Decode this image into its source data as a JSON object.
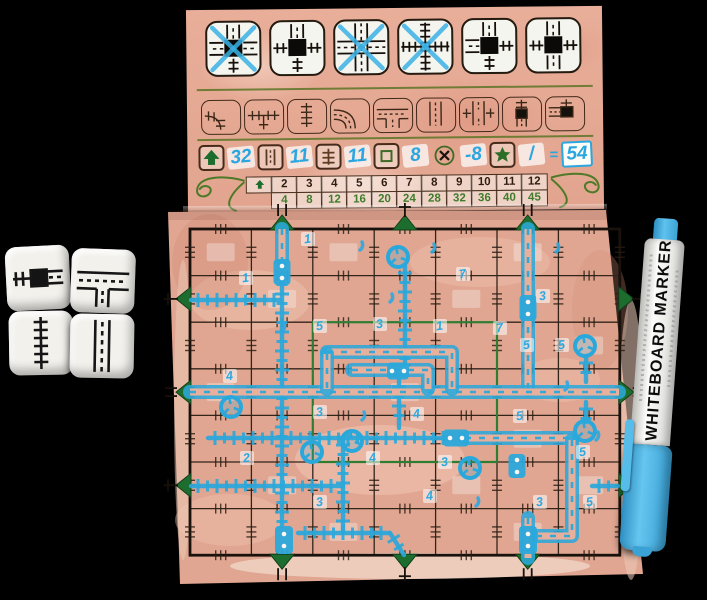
{
  "scene": {
    "background": "#000000"
  },
  "board": {
    "palette": {
      "paper": "#e2a894",
      "paper_light": "#f2cdb9",
      "line_dark": "#221812",
      "brown": "#4a2e1c",
      "olive": "#5c7426",
      "green": "#1d6e2e",
      "marker_blue": "#2ba8db",
      "tile_white": "#f5f5ef"
    },
    "special_tiles": [
      {
        "name": "special-road3-rail1",
        "up": "road",
        "right": "road",
        "down": "rail",
        "left": "road",
        "square": true,
        "crossed": true
      },
      {
        "name": "special-rail3-road1",
        "up": "road",
        "right": "rail",
        "down": "rail",
        "left": "rail",
        "square": true,
        "crossed": false
      },
      {
        "name": "special-road4",
        "up": "road",
        "right": "road",
        "down": "road",
        "left": "road",
        "square": false,
        "crossed": true
      },
      {
        "name": "special-rail4",
        "up": "rail",
        "right": "rail",
        "down": "rail",
        "left": "rail",
        "square": false,
        "crossed": true
      },
      {
        "name": "special-station-cross",
        "up": "road",
        "right": "rail",
        "down": "rail",
        "left": "road",
        "square": true,
        "crossed": false
      },
      {
        "name": "special-station-parallel",
        "up": "road",
        "right": "rail",
        "down": "road",
        "left": "rail",
        "square": true,
        "crossed": false
      }
    ],
    "reference_tiles": [
      "rail-curve",
      "rail-junction",
      "rail-straight",
      "road-curve",
      "road-junction",
      "road-straight",
      "overpass",
      "station-straight",
      "station-curve"
    ],
    "score_row": {
      "items": [
        {
          "icon": "exits-arrow-icon",
          "value": "32"
        },
        {
          "icon": "road-icon",
          "value": "11"
        },
        {
          "icon": "rail-icon",
          "value": "11"
        },
        {
          "icon": "center-square-icon",
          "value": "8"
        },
        {
          "icon": "error-cross-icon",
          "value": "-8"
        },
        {
          "icon": "star-icon",
          "value": "/"
        }
      ],
      "equals": "=",
      "total": "54"
    },
    "score_table": {
      "exit_counts": [
        "2",
        "3",
        "4",
        "5",
        "6",
        "7",
        "8",
        "9",
        "10",
        "11",
        "12"
      ],
      "points": [
        "4",
        "8",
        "12",
        "16",
        "20",
        "24",
        "28",
        "32",
        "36",
        "40",
        "45"
      ]
    },
    "grid": {
      "cols": 7,
      "rows": 7,
      "exits": {
        "top": [
          {
            "pos": 2,
            "type": "road"
          },
          {
            "pos": 4,
            "type": "rail"
          },
          {
            "pos": 6,
            "type": "road"
          }
        ],
        "bottom": [
          {
            "pos": 2,
            "type": "road"
          },
          {
            "pos": 4,
            "type": "rail"
          },
          {
            "pos": 6,
            "type": "road"
          }
        ],
        "left": [
          {
            "pos": 2,
            "type": "rail"
          },
          {
            "pos": 4,
            "type": "road"
          },
          {
            "pos": 6,
            "type": "rail"
          }
        ],
        "right": [
          {
            "pos": 2,
            "type": "rail"
          },
          {
            "pos": 4,
            "type": "road"
          },
          {
            "pos": 6,
            "type": "rail"
          }
        ]
      }
    },
    "drawing": {
      "rails": [
        [
          191,
          300,
          280,
          300
        ],
        [
          282,
          268,
          282,
          484
        ],
        [
          282,
          486,
          282,
          527
        ],
        [
          208,
          438,
          450,
          438
        ],
        [
          191,
          486,
          343,
          486
        ],
        [
          343,
          438,
          343,
          532
        ],
        [
          298,
          533,
          390,
          533
        ],
        [
          390,
          533,
          404,
          555
        ],
        [
          405,
          266,
          405,
          364
        ],
        [
          399,
          380,
          399,
          428
        ],
        [
          586,
          356,
          586,
          382
        ],
        [
          586,
          402,
          586,
          422
        ],
        [
          592,
          486,
          618,
          486
        ]
      ],
      "roads": [
        [
          [
            282,
            229
          ],
          [
            282,
            260
          ]
        ],
        [
          [
            528,
            229
          ],
          [
            528,
            390
          ]
        ],
        [
          [
            190,
            392
          ],
          [
            619,
            392
          ]
        ],
        [
          [
            327,
            352
          ],
          [
            452,
            352
          ],
          [
            452,
            389
          ]
        ],
        [
          [
            327,
            354
          ],
          [
            327,
            389
          ]
        ],
        [
          [
            352,
            370
          ],
          [
            428,
            370
          ],
          [
            428,
            389
          ]
        ],
        [
          [
            465,
            438
          ],
          [
            572,
            438
          ]
        ],
        [
          [
            572,
            440
          ],
          [
            572,
            536
          ],
          [
            538,
            536
          ]
        ],
        [
          [
            528,
            518
          ],
          [
            528,
            558
          ]
        ]
      ],
      "stations": [
        {
          "x": 282,
          "y": 272,
          "w": 17,
          "h": 26,
          "o": "v"
        },
        {
          "x": 528,
          "y": 308,
          "w": 17,
          "h": 26,
          "o": "v"
        },
        {
          "x": 398,
          "y": 371,
          "w": 22,
          "h": 17,
          "o": "h"
        },
        {
          "x": 456,
          "y": 438,
          "w": 26,
          "h": 17,
          "o": "h"
        },
        {
          "x": 284,
          "y": 540,
          "w": 18,
          "h": 28,
          "o": "v"
        },
        {
          "x": 528,
          "y": 540,
          "w": 18,
          "h": 28,
          "o": "v"
        },
        {
          "x": 517,
          "y": 466,
          "w": 17,
          "h": 24,
          "o": "v"
        }
      ],
      "roundabouts": [
        [
          398,
          257
        ],
        [
          585,
          346
        ],
        [
          585,
          431
        ],
        [
          231,
          407
        ],
        [
          312,
          452
        ],
        [
          352,
          441
        ],
        [
          470,
          468
        ]
      ],
      "digits": [
        {
          "t": "1",
          "x": 246,
          "y": 282
        },
        {
          "t": "1",
          "x": 308,
          "y": 243
        },
        {
          "t": "7",
          "x": 463,
          "y": 278
        },
        {
          "t": "3",
          "x": 543,
          "y": 300
        },
        {
          "t": "5",
          "x": 320,
          "y": 330
        },
        {
          "t": "3",
          "x": 380,
          "y": 328
        },
        {
          "t": "1",
          "x": 440,
          "y": 330
        },
        {
          "t": "7",
          "x": 500,
          "y": 332
        },
        {
          "t": "4",
          "x": 230,
          "y": 380
        },
        {
          "t": "5",
          "x": 527,
          "y": 349
        },
        {
          "t": "5",
          "x": 562,
          "y": 349
        },
        {
          "t": "3",
          "x": 320,
          "y": 416
        },
        {
          "t": "4",
          "x": 417,
          "y": 418
        },
        {
          "t": "5",
          "x": 520,
          "y": 420
        },
        {
          "t": "5",
          "x": 583,
          "y": 456
        },
        {
          "t": "2",
          "x": 247,
          "y": 462
        },
        {
          "t": "4",
          "x": 373,
          "y": 462
        },
        {
          "t": "3",
          "x": 445,
          "y": 466
        },
        {
          "t": "3",
          "x": 320,
          "y": 506
        },
        {
          "t": "4",
          "x": 430,
          "y": 500
        },
        {
          "t": "3",
          "x": 540,
          "y": 506
        },
        {
          "t": "5",
          "x": 590,
          "y": 506
        }
      ],
      "marks": [
        [
          360,
          250
        ],
        [
          432,
          252
        ],
        [
          556,
          252
        ],
        [
          390,
          302
        ],
        [
          282,
          331
        ],
        [
          565,
          390
        ],
        [
          596,
          440
        ],
        [
          476,
          506
        ],
        [
          362,
          420
        ]
      ]
    }
  },
  "dice": [
    {
      "face": "station-straight"
    },
    {
      "face": "road-junction"
    },
    {
      "face": "rail-straight"
    },
    {
      "face": "road-straight"
    }
  ],
  "marker": {
    "label": "WHITEBOARD MARKER"
  }
}
